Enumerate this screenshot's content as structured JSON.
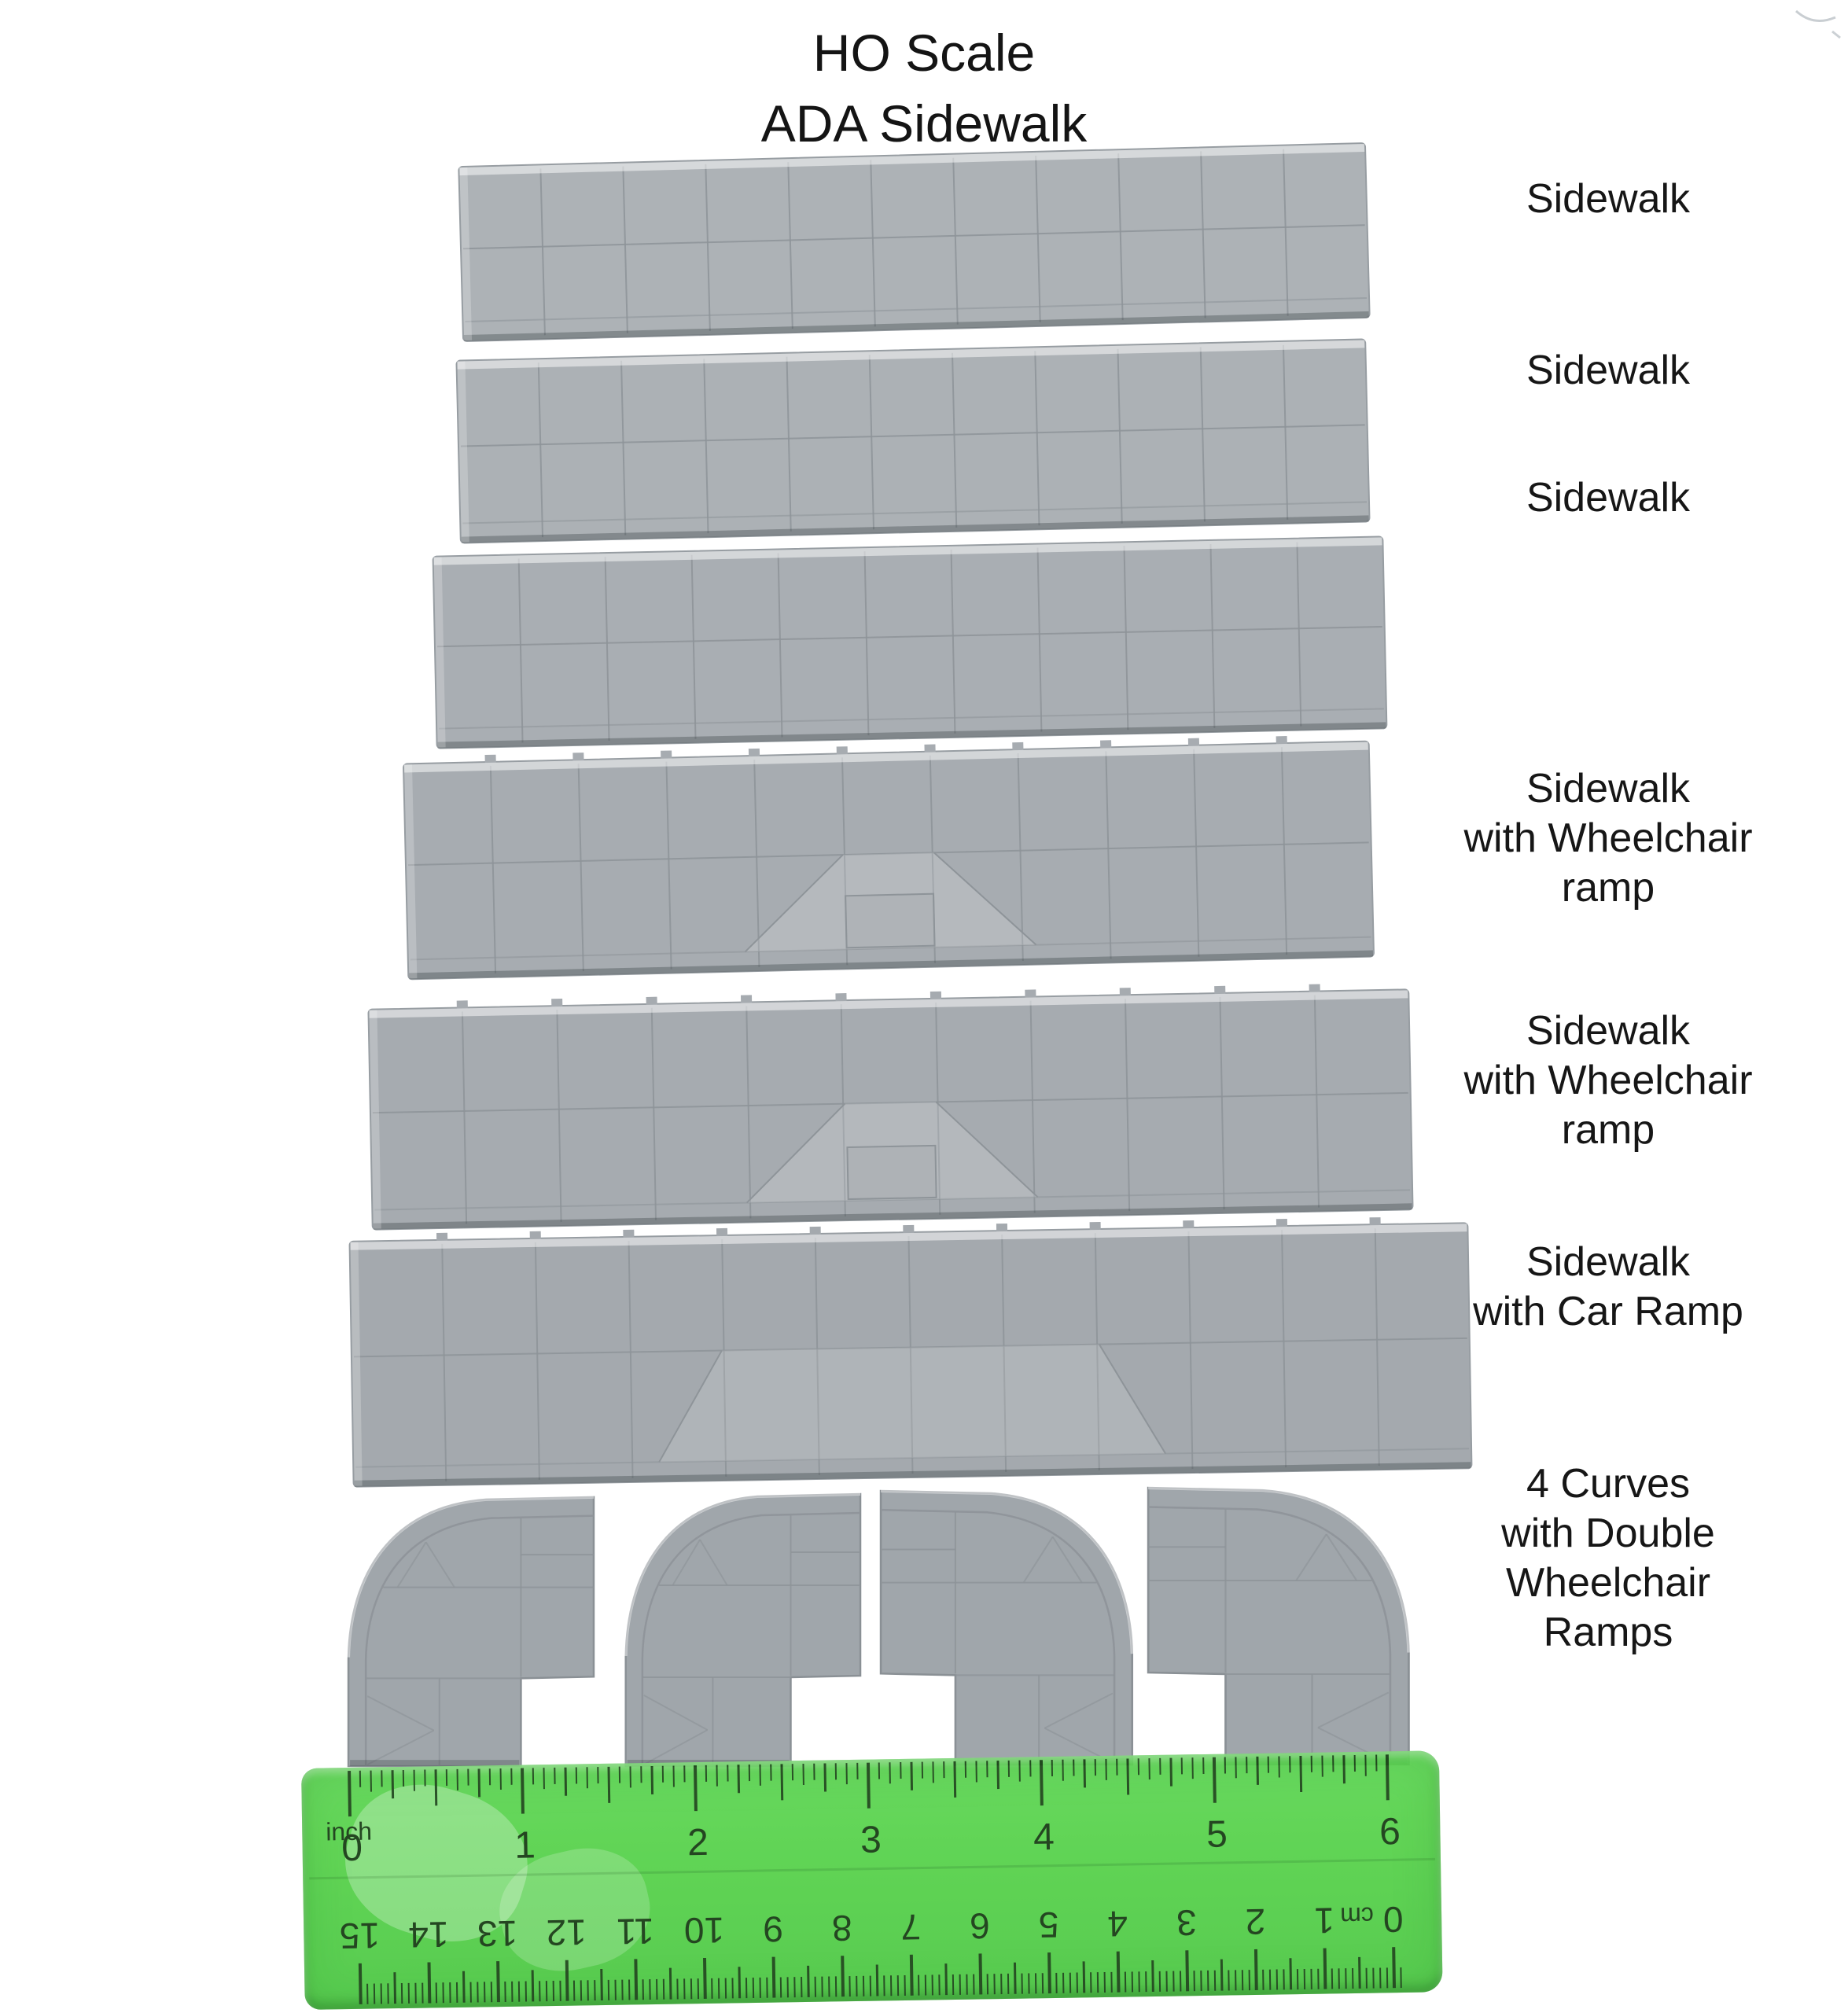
{
  "title": {
    "line1": "HO Scale",
    "line2": "ADA Sidewalk"
  },
  "labels": [
    {
      "lines": [
        "Sidewalk"
      ]
    },
    {
      "lines": [
        "Sidewalk"
      ]
    },
    {
      "lines": [
        "Sidewalk"
      ]
    },
    {
      "lines": [
        "Sidewalk",
        "with Wheelchair",
        "ramp"
      ]
    },
    {
      "lines": [
        "Sidewalk",
        "with Wheelchair",
        "ramp"
      ]
    },
    {
      "lines": [
        "Sidewalk",
        "with Car Ramp"
      ]
    },
    {
      "lines": [
        "4 Curves",
        "with Double",
        "Wheelchair",
        "Ramps"
      ]
    }
  ],
  "pieces": [
    {
      "kind": "plain",
      "columns": 11,
      "fill": "#adb2b6"
    },
    {
      "kind": "plain",
      "columns": 11,
      "fill": "#acb1b5"
    },
    {
      "kind": "plain",
      "columns": 11,
      "fill": "#a9aeb3"
    },
    {
      "kind": "wheelchair",
      "columns": 11,
      "fill": "#a7acb1"
    },
    {
      "kind": "wheelchair",
      "columns": 11,
      "fill": "#a6abb0"
    },
    {
      "kind": "car",
      "columns": 12,
      "fill": "#a4a9ae"
    }
  ],
  "curves": {
    "count": 4,
    "fill": "#a0a6ab"
  },
  "ruler": {
    "unit_top": "inch",
    "unit_bottom": "cm",
    "inch_numbers": [
      "0",
      "1",
      "2",
      "3",
      "4",
      "5",
      "6"
    ],
    "cm_numbers": [
      "15",
      "14",
      "13",
      "12",
      "11",
      "10",
      "9",
      "8",
      "7",
      "6",
      "5",
      "4",
      "3",
      "2",
      "1",
      "0"
    ],
    "color": "#55d14a",
    "marking_color": "#143911"
  },
  "colors": {
    "background": "#ffffff",
    "plastic_gray": "#aaafb3",
    "grid_line": "#8e9499",
    "text": "#161616"
  }
}
